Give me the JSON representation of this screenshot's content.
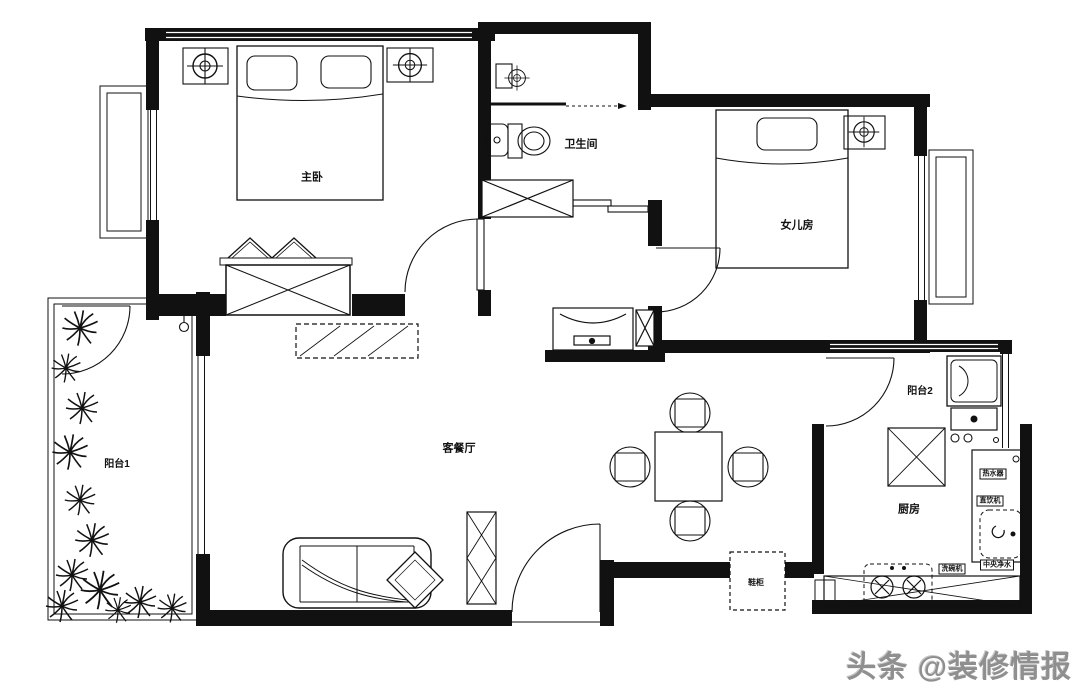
{
  "plan": {
    "rooms": [
      {
        "id": "master-bedroom",
        "label": "主卧"
      },
      {
        "id": "bathroom",
        "label": "卫生间"
      },
      {
        "id": "daughter-room",
        "label": "女儿房"
      },
      {
        "id": "balcony-1",
        "label": "阳台1"
      },
      {
        "id": "living-dining",
        "label": "客餐厅"
      },
      {
        "id": "balcony-2",
        "label": "阳台2"
      },
      {
        "id": "kitchen",
        "label": "厨房"
      },
      {
        "id": "shoe-cabinet",
        "label": "鞋柜"
      }
    ],
    "appliances": [
      {
        "id": "water-heater",
        "label": "热水器"
      },
      {
        "id": "water-dispenser",
        "label": "直饮机"
      },
      {
        "id": "dishwasher",
        "label": "洗碗机"
      },
      {
        "id": "central-water-purifier",
        "label": "中央净水"
      }
    ],
    "colors": {
      "ink": "#111111",
      "background": "#ffffff",
      "watermark": "#8f8f8f"
    }
  },
  "watermark": {
    "text": "头条 @装修情报"
  }
}
